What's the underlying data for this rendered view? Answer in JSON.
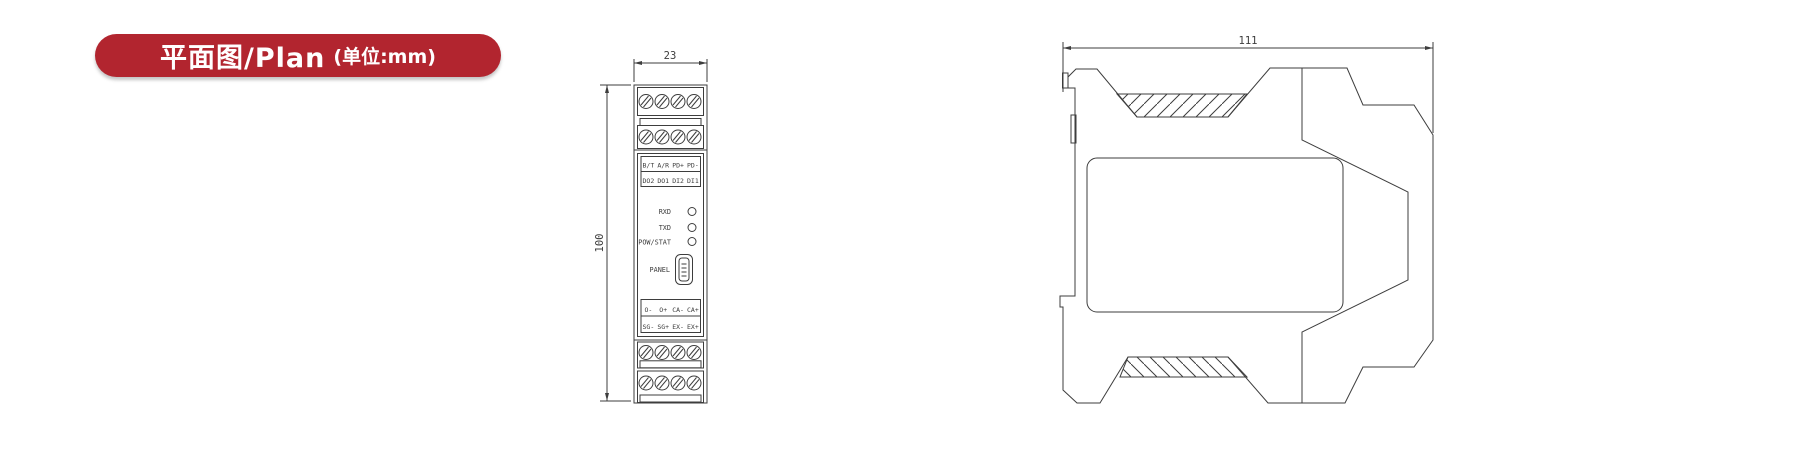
{
  "badge": {
    "title": "平面图/Plan",
    "unit": "(单位:mm)",
    "bg_color": "#b2252f",
    "text_color": "#ffffff"
  },
  "front_view": {
    "dim_width": "23",
    "dim_height": "100",
    "terminal_labels_top": {
      "row1": [
        "B/T",
        "A/R",
        "PD+",
        "PD-"
      ],
      "row2": [
        "DO2",
        "DO1",
        "DI2",
        "DI1"
      ]
    },
    "led_labels": [
      "RXD",
      "TXD",
      "POW/STAT"
    ],
    "panel_label": "PANEL",
    "terminal_labels_bottom": {
      "row1": [
        "O-",
        "O+",
        "CA-",
        "CA+"
      ],
      "row2": [
        "SG-",
        "SG+",
        "EX-",
        "EX+"
      ]
    }
  },
  "side_view": {
    "dim_width": "111"
  },
  "drawing": {
    "line_color": "#3d3d3d"
  }
}
